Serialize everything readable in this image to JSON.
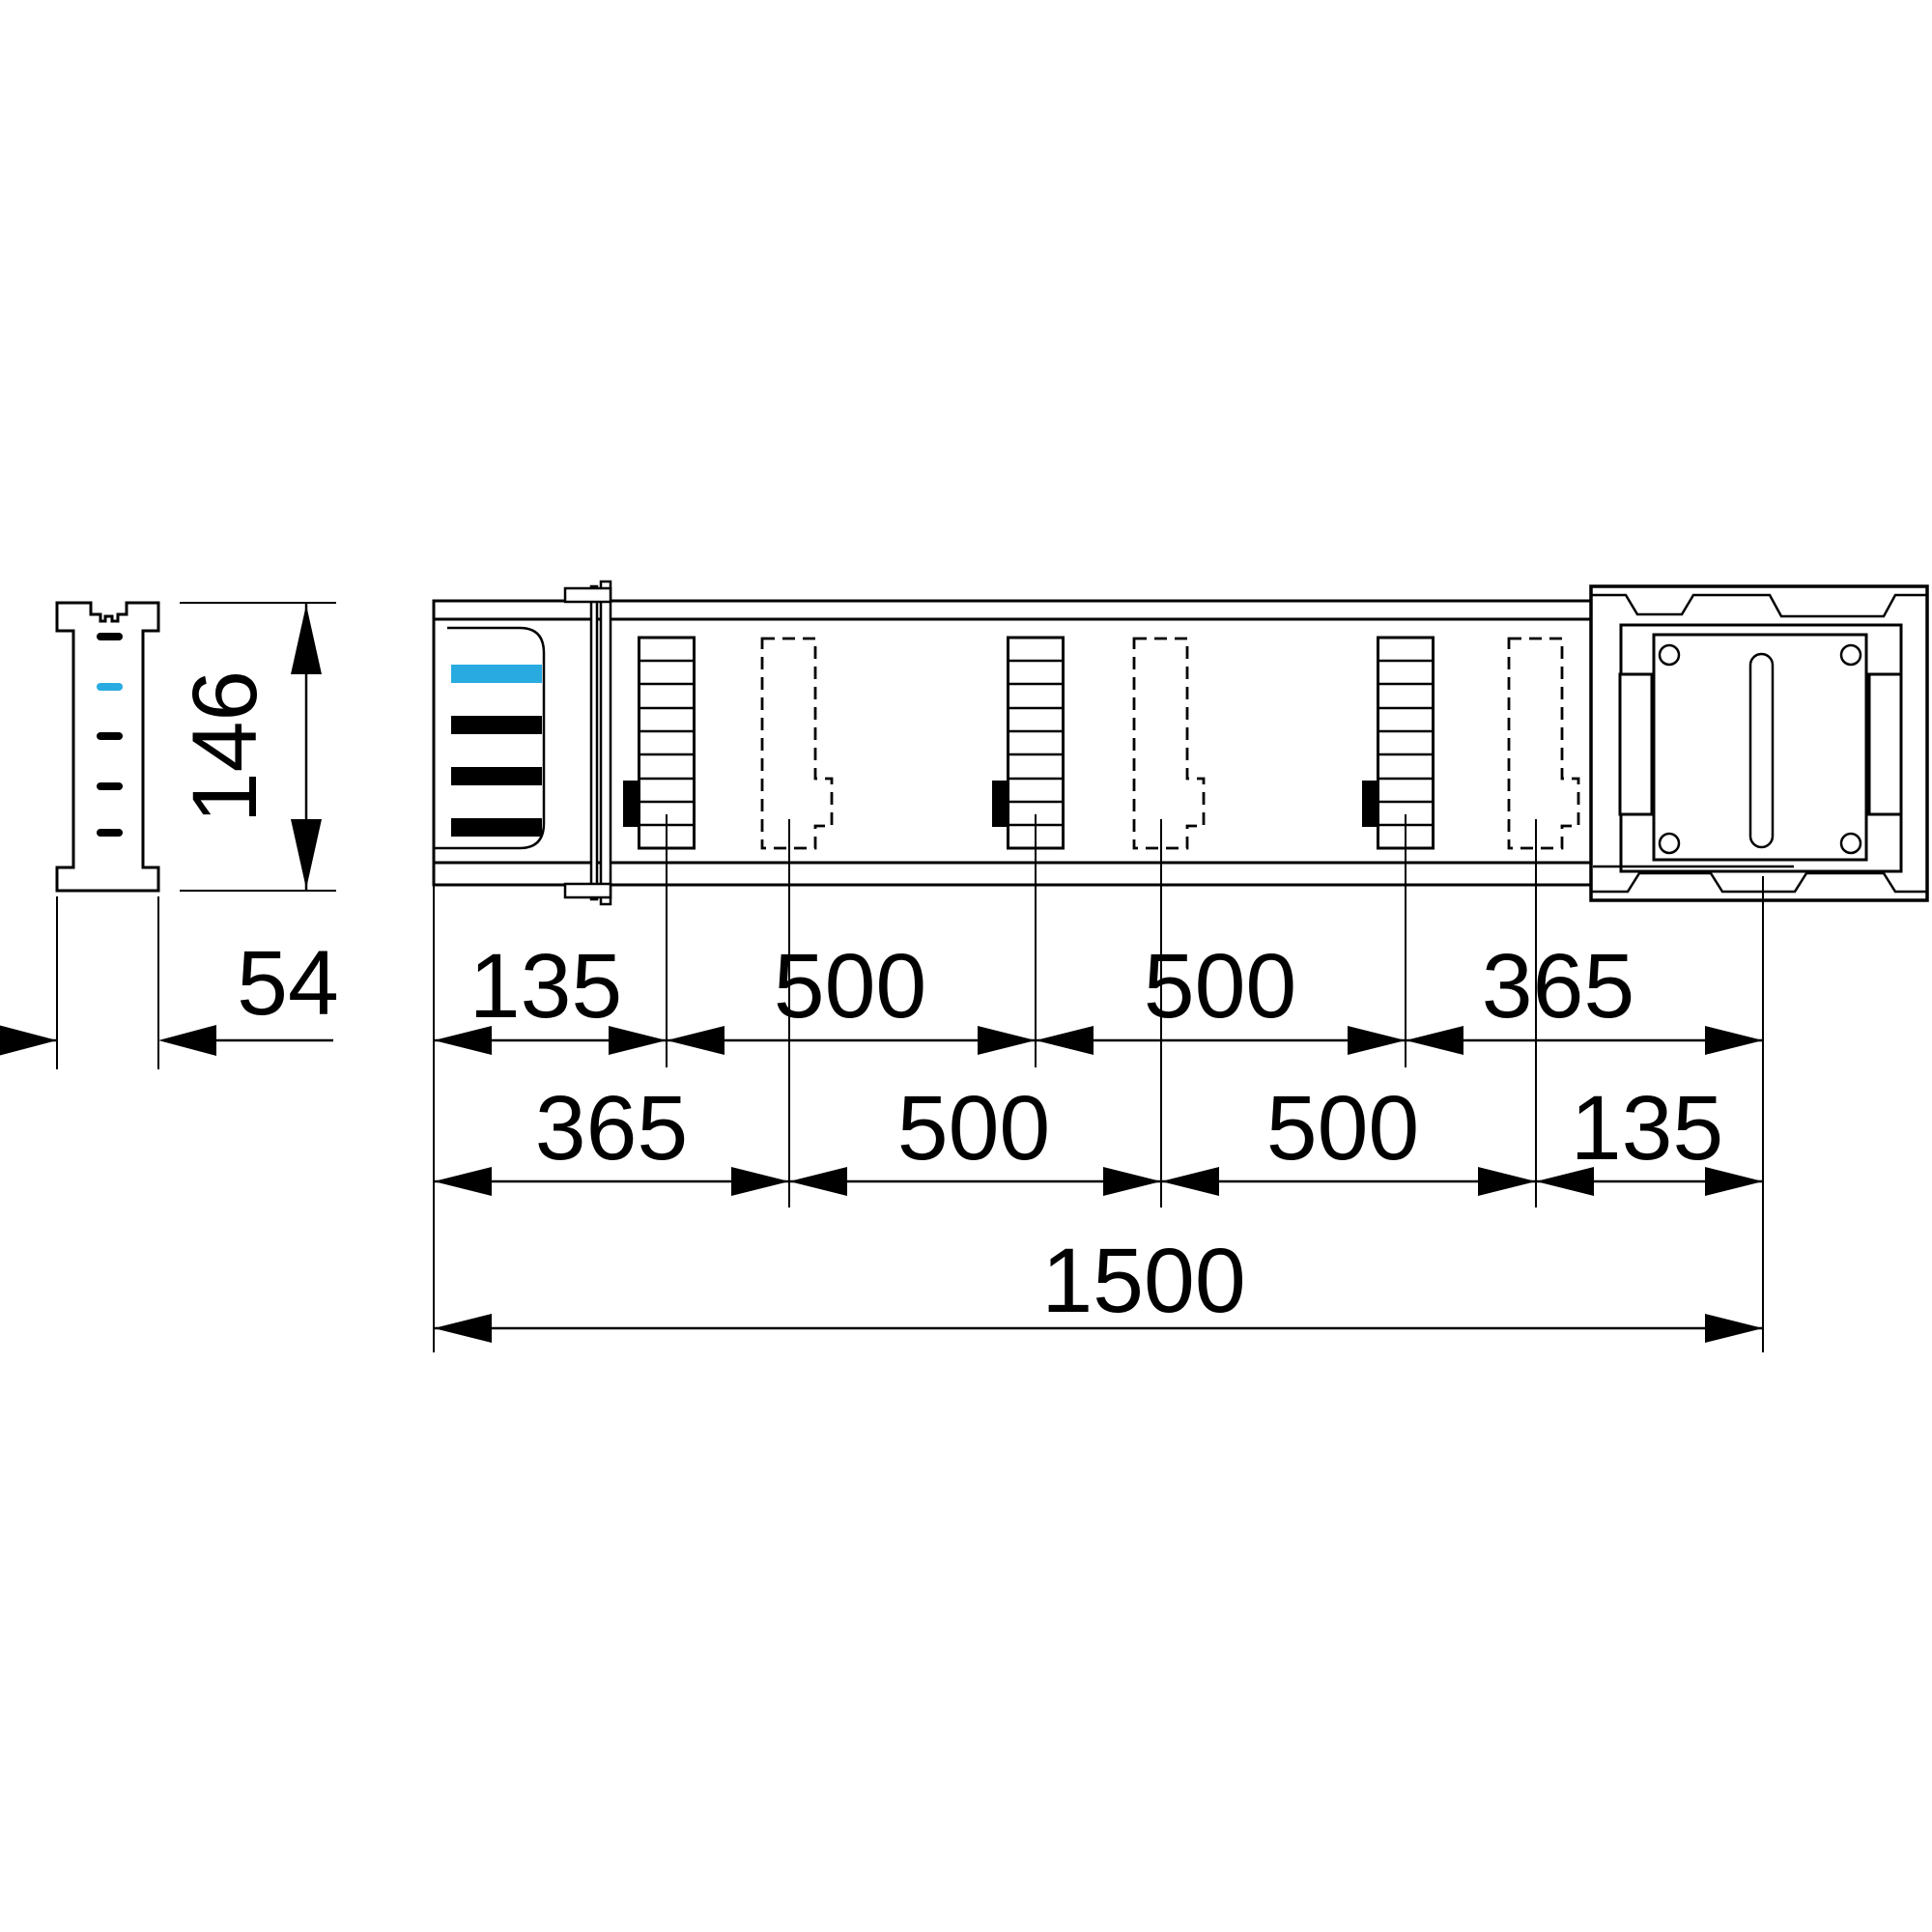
{
  "side_view": {
    "height_label": "146",
    "width_label": "54"
  },
  "plan_view": {
    "row_top": {
      "labels": [
        "135",
        "500",
        "500",
        "365"
      ]
    },
    "row_middle": {
      "labels": [
        "365",
        "500",
        "500",
        "135"
      ]
    },
    "row_total": {
      "label": "1500"
    }
  },
  "colors": {
    "accent": "#29ABE2",
    "line": "#000000",
    "background": "#FFFFFF"
  }
}
